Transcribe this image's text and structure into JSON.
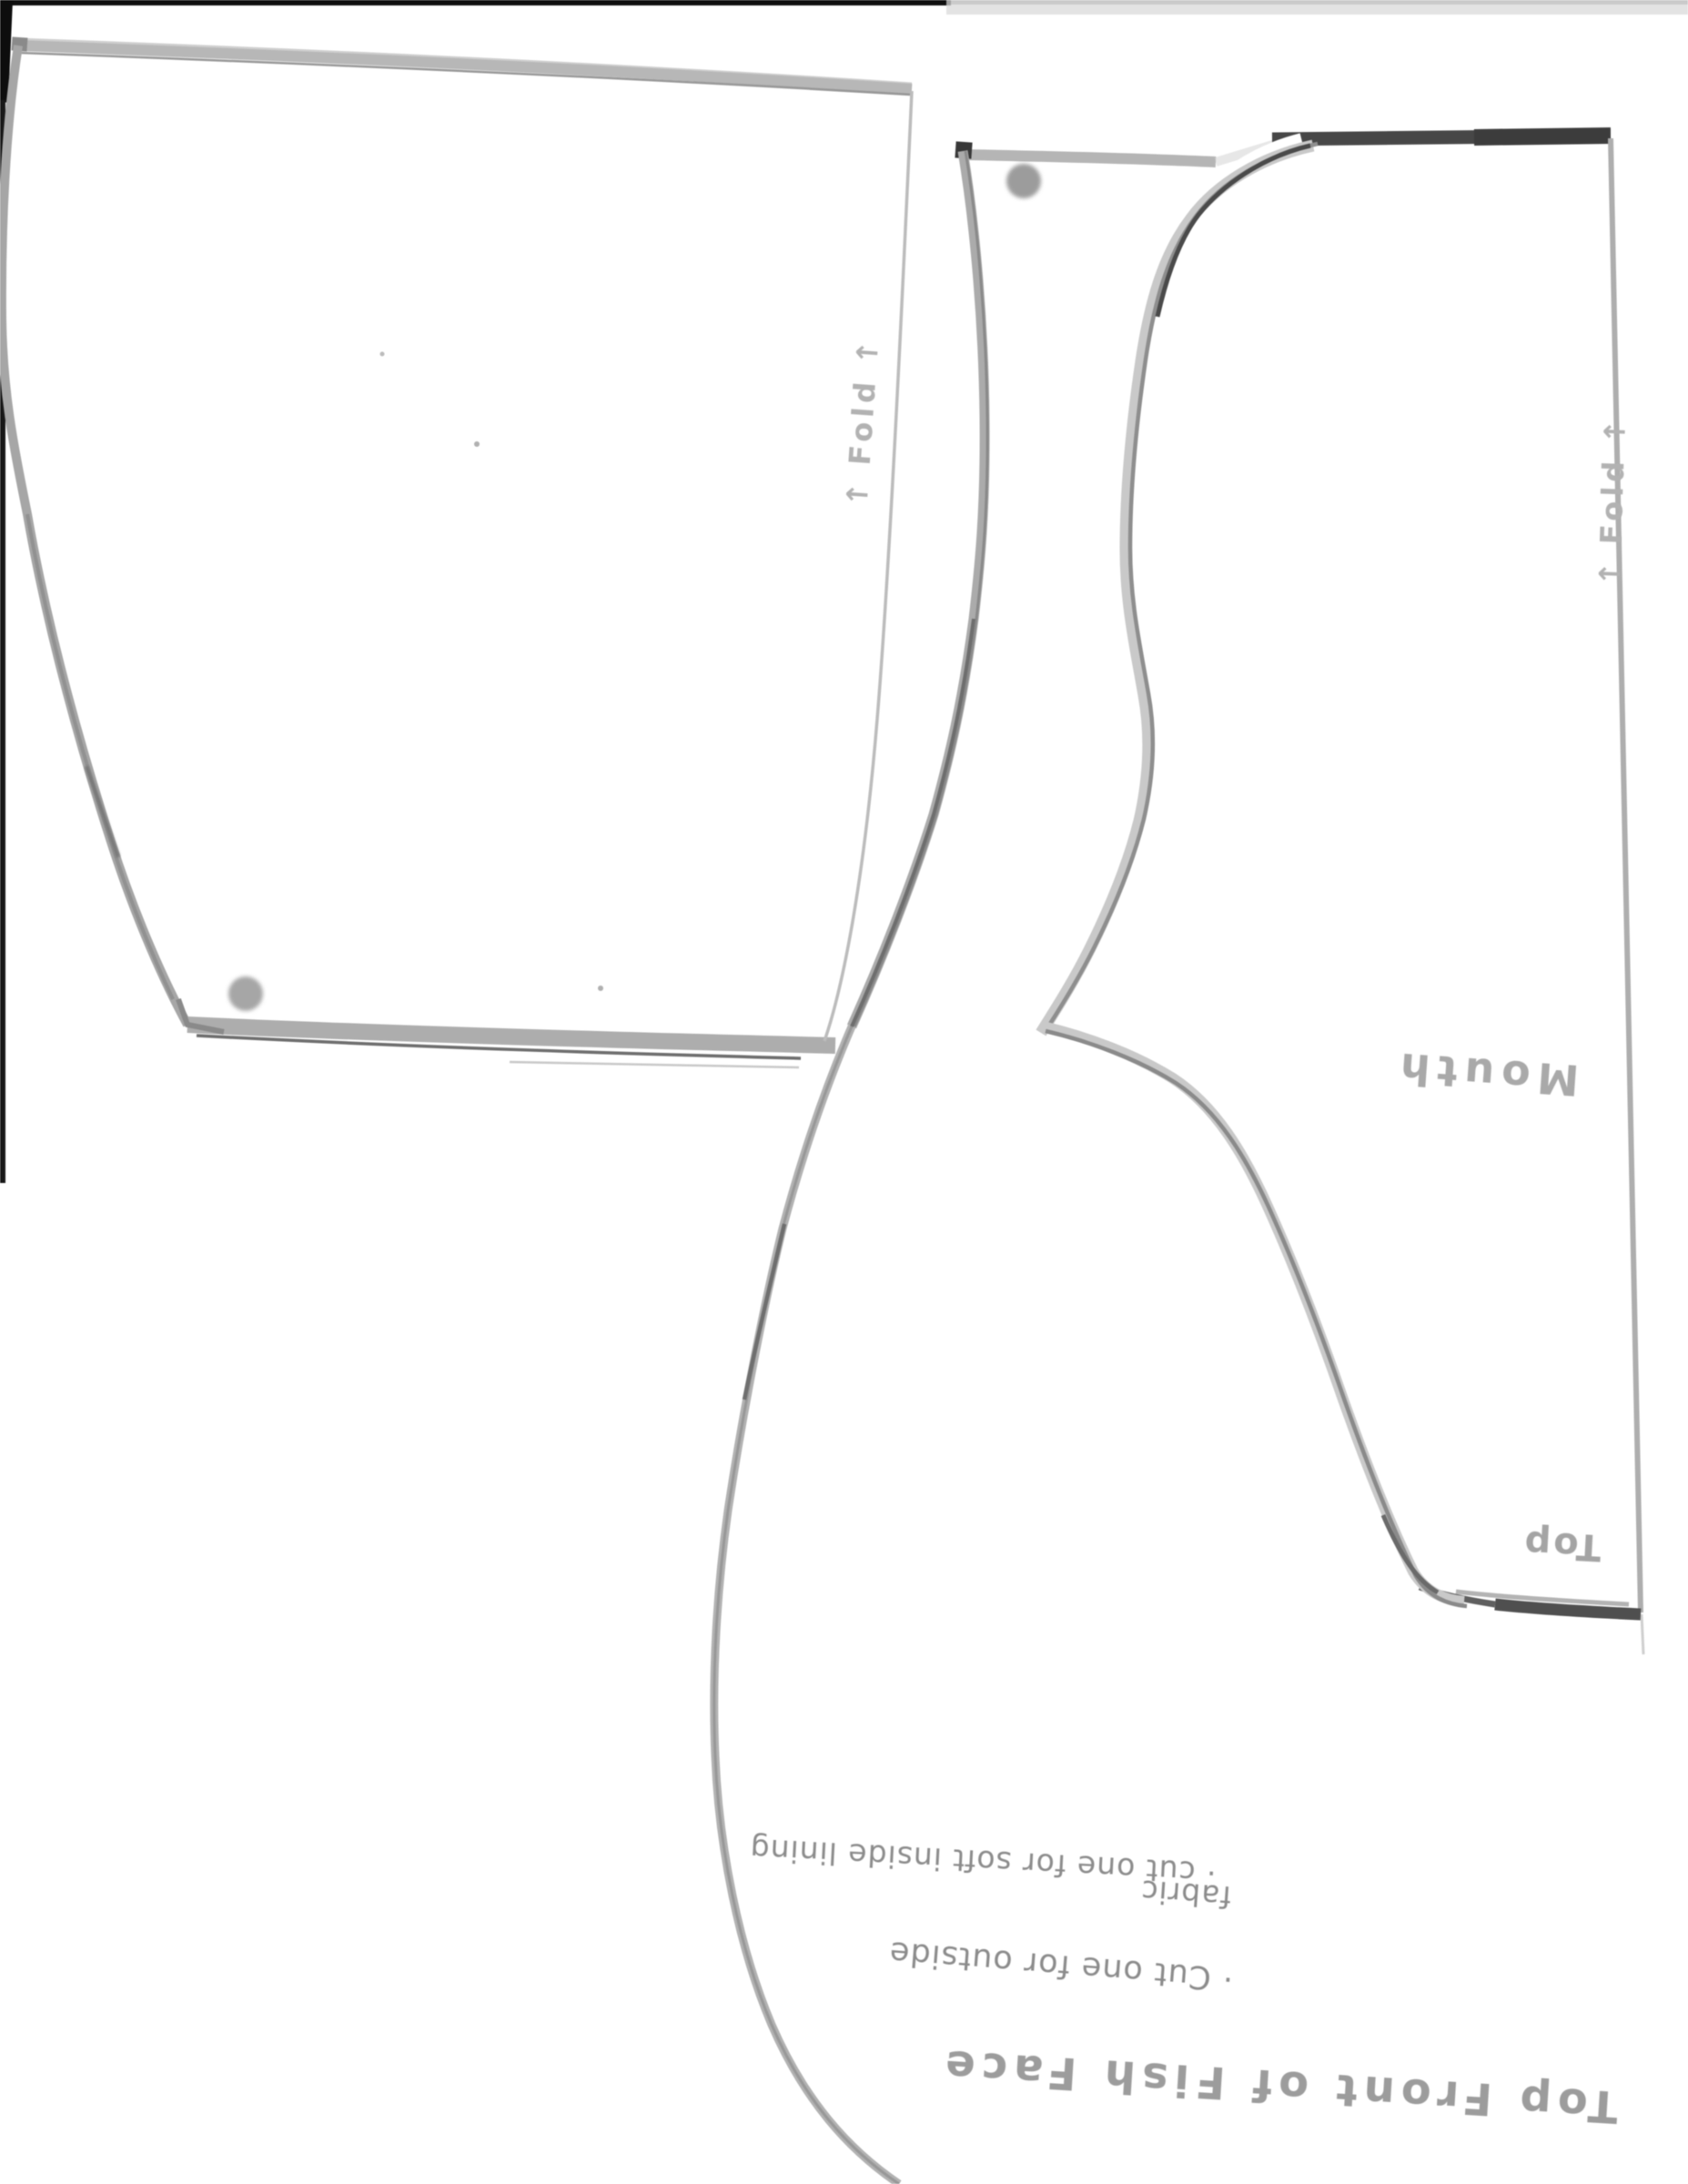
{
  "document": {
    "type": "scanned sewing pattern page",
    "orientation_note": "handwritten labels appear upside down (page scanned rotated 180°)"
  },
  "labels": {
    "fold_left": {
      "arrow": "↑",
      "text": "Fold"
    },
    "fold_right": {
      "arrow": "↑",
      "text": "Fold"
    },
    "mouth": "Mouth",
    "top": "Top",
    "title": "Top Front of Fish Face",
    "instructions": {
      "line1": "· Cut one for outside",
      "line2": "fabric",
      "line3": "· cut one for soft inside lining"
    }
  },
  "colors": {
    "paper": "#ffffff",
    "scan_edge": "#141414",
    "marker_dark": "#474747",
    "pencil_mid": "#8e8e8e",
    "pencil_light": "#b5b5b5",
    "handwriting": "#8b8b8b",
    "handwriting_light": "#a8a8a8"
  }
}
